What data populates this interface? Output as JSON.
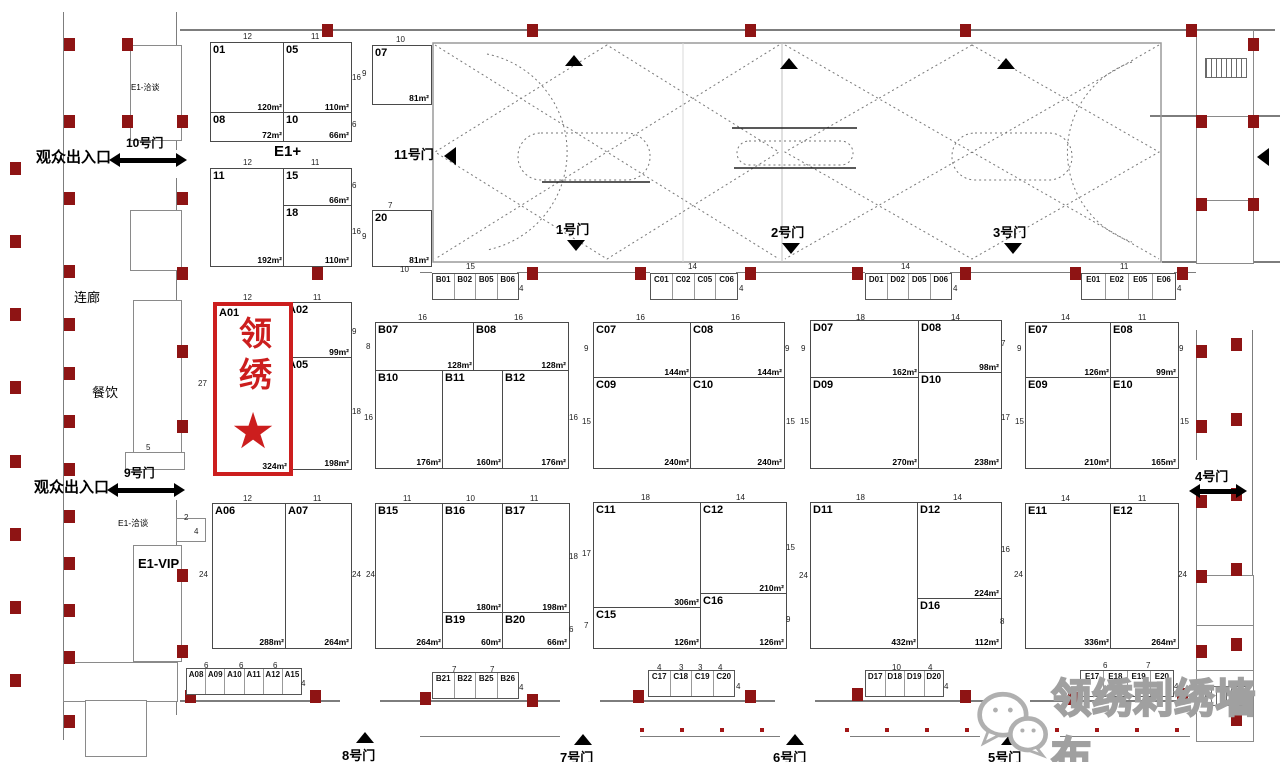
{
  "colors": {
    "highlight_red": "#cc1e1e",
    "column_red": "#8e1414",
    "wall_gray": "#7d7d7d",
    "watermark_gray": "#a0a0a0"
  },
  "labels": {
    "entrance_top": "观众出入口",
    "gate_10": "10号门",
    "entrance_mid": "观众出入口",
    "gate_9": "9号门",
    "gate_11": "11号门",
    "gate_1": "1号门",
    "gate_2": "2号门",
    "gate_3": "3号门",
    "gate_4": "4号门",
    "gate_5": "5号门",
    "gate_6": "6号门",
    "gate_7": "7号门",
    "gate_8": "8号门",
    "corridor": "连廊",
    "dining": "餐饮",
    "e1_talk_top": "E1-洽谈",
    "e1_talk": "E1-洽谈",
    "e1_vip": "E1-VIP",
    "e1_plus": "E1+"
  },
  "highlight": {
    "booth": "A01",
    "name": "领绣",
    "star": "★",
    "area": "324m²"
  },
  "watermark": {
    "text": "领绣刺绣墙布",
    "icon": "wechat-icon"
  },
  "booths": [
    {
      "id": "01",
      "area": "120m²",
      "x": 210,
      "y": 42,
      "w": 73,
      "h": 70
    },
    {
      "id": "05",
      "area": "110m²",
      "x": 283,
      "y": 42,
      "w": 67,
      "h": 70
    },
    {
      "id": "08",
      "area": "72m²",
      "x": 210,
      "y": 112,
      "w": 73,
      "h": 28
    },
    {
      "id": "10",
      "area": "66m²",
      "x": 283,
      "y": 112,
      "w": 67,
      "h": 28
    },
    {
      "id": "11",
      "area": "192m²",
      "x": 210,
      "y": 168,
      "w": 73,
      "h": 97
    },
    {
      "id": "15",
      "area": "66m²",
      "x": 283,
      "y": 168,
      "w": 67,
      "h": 37
    },
    {
      "id": "18",
      "area": "110m²",
      "x": 283,
      "y": 205,
      "w": 67,
      "h": 60
    },
    {
      "id": "07",
      "area": "81m²",
      "x": 372,
      "y": 45,
      "w": 58,
      "h": 58
    },
    {
      "id": "20",
      "area": "81m²",
      "x": 372,
      "y": 210,
      "w": 58,
      "h": 55
    },
    {
      "id": "A01",
      "area": "324m²",
      "x": 213,
      "y": 302,
      "w": 72,
      "h": 166,
      "highlight": true
    },
    {
      "id": "A02",
      "area": "99m²",
      "x": 285,
      "y": 302,
      "w": 65,
      "h": 55
    },
    {
      "id": "A05",
      "area": "198m²",
      "x": 285,
      "y": 357,
      "w": 65,
      "h": 111
    },
    {
      "id": "A06",
      "area": "288m²",
      "x": 212,
      "y": 503,
      "w": 73,
      "h": 144
    },
    {
      "id": "A07",
      "area": "264m²",
      "x": 285,
      "y": 503,
      "w": 65,
      "h": 144
    },
    {
      "id": "B07",
      "area": "128m²",
      "x": 375,
      "y": 322,
      "w": 98,
      "h": 48
    },
    {
      "id": "B08",
      "area": "128m²",
      "x": 473,
      "y": 322,
      "w": 94,
      "h": 48
    },
    {
      "id": "B10",
      "area": "176m²",
      "x": 375,
      "y": 370,
      "w": 67,
      "h": 97
    },
    {
      "id": "B11",
      "area": "160m²",
      "x": 442,
      "y": 370,
      "w": 60,
      "h": 97
    },
    {
      "id": "B12",
      "area": "176m²",
      "x": 502,
      "y": 370,
      "w": 65,
      "h": 97
    },
    {
      "id": "B15",
      "area": "264m²",
      "x": 375,
      "y": 503,
      "w": 67,
      "h": 144
    },
    {
      "id": "B16",
      "area": "180m²",
      "x": 442,
      "y": 503,
      "w": 60,
      "h": 109
    },
    {
      "id": "B17",
      "area": "198m²",
      "x": 502,
      "y": 503,
      "w": 66,
      "h": 109
    },
    {
      "id": "B19",
      "area": "60m²",
      "x": 442,
      "y": 612,
      "w": 60,
      "h": 35
    },
    {
      "id": "B20",
      "area": "66m²",
      "x": 502,
      "y": 612,
      "w": 66,
      "h": 35
    },
    {
      "id": "C07",
      "area": "144m²",
      "x": 593,
      "y": 322,
      "w": 97,
      "h": 55
    },
    {
      "id": "C08",
      "area": "144m²",
      "x": 690,
      "y": 322,
      "w": 93,
      "h": 55
    },
    {
      "id": "C09",
      "area": "240m²",
      "x": 593,
      "y": 377,
      "w": 97,
      "h": 90
    },
    {
      "id": "C10",
      "area": "240m²",
      "x": 690,
      "y": 377,
      "w": 93,
      "h": 90
    },
    {
      "id": "C11",
      "area": "306m²",
      "x": 593,
      "y": 502,
      "w": 107,
      "h": 105
    },
    {
      "id": "C12",
      "area": "210m²",
      "x": 700,
      "y": 502,
      "w": 85,
      "h": 91
    },
    {
      "id": "C15",
      "area": "126m²",
      "x": 593,
      "y": 607,
      "w": 107,
      "h": 40
    },
    {
      "id": "C16",
      "area": "126m²",
      "x": 700,
      "y": 593,
      "w": 85,
      "h": 54
    },
    {
      "id": "D07",
      "area": "162m²",
      "x": 810,
      "y": 320,
      "w": 108,
      "h": 57
    },
    {
      "id": "D08",
      "area": "98m²",
      "x": 918,
      "y": 320,
      "w": 82,
      "h": 52
    },
    {
      "id": "D09",
      "area": "270m²",
      "x": 810,
      "y": 377,
      "w": 108,
      "h": 90
    },
    {
      "id": "D10",
      "area": "238m²",
      "x": 918,
      "y": 372,
      "w": 82,
      "h": 95
    },
    {
      "id": "D11",
      "area": "432m²",
      "x": 810,
      "y": 502,
      "w": 107,
      "h": 145
    },
    {
      "id": "D12",
      "area": "224m²",
      "x": 917,
      "y": 502,
      "w": 83,
      "h": 96
    },
    {
      "id": "D16",
      "area": "112m²",
      "x": 917,
      "y": 598,
      "w": 83,
      "h": 49
    },
    {
      "id": "E07",
      "area": "126m²",
      "x": 1025,
      "y": 322,
      "w": 85,
      "h": 55
    },
    {
      "id": "E08",
      "area": "99m²",
      "x": 1110,
      "y": 322,
      "w": 67,
      "h": 55
    },
    {
      "id": "E09",
      "area": "210m²",
      "x": 1025,
      "y": 377,
      "w": 85,
      "h": 90
    },
    {
      "id": "E10",
      "area": "165m²",
      "x": 1110,
      "y": 377,
      "w": 67,
      "h": 90
    },
    {
      "id": "E11",
      "area": "336m²",
      "x": 1025,
      "y": 503,
      "w": 85,
      "h": 144
    },
    {
      "id": "E12",
      "area": "264m²",
      "x": 1110,
      "y": 503,
      "w": 67,
      "h": 144
    }
  ],
  "strips": [
    {
      "x": 432,
      "y": 273,
      "w": 85,
      "h": 25,
      "cells": [
        "B01",
        "B02",
        "B05",
        "B06"
      ]
    },
    {
      "x": 650,
      "y": 273,
      "w": 86,
      "h": 25,
      "cells": [
        "C01",
        "C02",
        "C05",
        "C06"
      ]
    },
    {
      "x": 865,
      "y": 273,
      "w": 85,
      "h": 25,
      "cells": [
        "D01",
        "D02",
        "D05",
        "D06"
      ]
    },
    {
      "x": 1081,
      "y": 273,
      "w": 93,
      "h": 25,
      "cells": [
        "E01",
        "E02",
        "E05",
        "E06"
      ]
    },
    {
      "x": 186,
      "y": 668,
      "w": 114,
      "h": 25,
      "cells": [
        "A08",
        "A09",
        "A10",
        "A11",
        "A12",
        "A15"
      ]
    },
    {
      "x": 432,
      "y": 672,
      "w": 85,
      "h": 25,
      "cells": [
        "B21",
        "B22",
        "B25",
        "B26"
      ]
    },
    {
      "x": 648,
      "y": 670,
      "w": 85,
      "h": 25,
      "cells": [
        "C17",
        "C18",
        "C19",
        "C20"
      ]
    },
    {
      "x": 865,
      "y": 670,
      "w": 77,
      "h": 25,
      "cells": [
        "D17",
        "D18",
        "D19",
        "D20"
      ]
    },
    {
      "x": 1080,
      "y": 670,
      "w": 92,
      "h": 25,
      "cells": [
        "E17",
        "E18",
        "E19",
        "E20"
      ]
    }
  ],
  "dims": [
    {
      "t": "12",
      "x": 243,
      "y": 33
    },
    {
      "t": "11",
      "x": 311,
      "y": 33
    },
    {
      "t": "16",
      "x": 352,
      "y": 74
    },
    {
      "t": "6",
      "x": 352,
      "y": 121
    },
    {
      "t": "10",
      "x": 396,
      "y": 36
    },
    {
      "t": "9",
      "x": 362,
      "y": 70
    },
    {
      "t": "12",
      "x": 243,
      "y": 159
    },
    {
      "t": "11",
      "x": 311,
      "y": 159
    },
    {
      "t": "6",
      "x": 352,
      "y": 182
    },
    {
      "t": "16",
      "x": 352,
      "y": 228
    },
    {
      "t": "7",
      "x": 388,
      "y": 202
    },
    {
      "t": "9",
      "x": 362,
      "y": 233
    },
    {
      "t": "10",
      "x": 400,
      "y": 266
    },
    {
      "t": "15",
      "x": 466,
      "y": 263
    },
    {
      "t": "4",
      "x": 519,
      "y": 285
    },
    {
      "t": "14",
      "x": 688,
      "y": 263
    },
    {
      "t": "4",
      "x": 739,
      "y": 285
    },
    {
      "t": "14",
      "x": 901,
      "y": 263
    },
    {
      "t": "4",
      "x": 953,
      "y": 285
    },
    {
      "t": "11",
      "x": 1120,
      "y": 263
    },
    {
      "t": "4",
      "x": 1177,
      "y": 285
    },
    {
      "t": "12",
      "x": 243,
      "y": 294
    },
    {
      "t": "11",
      "x": 313,
      "y": 294
    },
    {
      "t": "9",
      "x": 352,
      "y": 328
    },
    {
      "t": "18",
      "x": 352,
      "y": 408
    },
    {
      "t": "27",
      "x": 198,
      "y": 380
    },
    {
      "t": "16",
      "x": 418,
      "y": 314
    },
    {
      "t": "16",
      "x": 514,
      "y": 314
    },
    {
      "t": "8",
      "x": 366,
      "y": 343
    },
    {
      "t": "16",
      "x": 364,
      "y": 414
    },
    {
      "t": "16",
      "x": 569,
      "y": 414
    },
    {
      "t": "16",
      "x": 636,
      "y": 314
    },
    {
      "t": "16",
      "x": 731,
      "y": 314
    },
    {
      "t": "9",
      "x": 584,
      "y": 345
    },
    {
      "t": "9",
      "x": 785,
      "y": 345
    },
    {
      "t": "15",
      "x": 582,
      "y": 418
    },
    {
      "t": "15",
      "x": 786,
      "y": 418
    },
    {
      "t": "18",
      "x": 856,
      "y": 314
    },
    {
      "t": "14",
      "x": 951,
      "y": 314
    },
    {
      "t": "9",
      "x": 801,
      "y": 345
    },
    {
      "t": "7",
      "x": 1001,
      "y": 340
    },
    {
      "t": "15",
      "x": 800,
      "y": 418
    },
    {
      "t": "17",
      "x": 1001,
      "y": 414
    },
    {
      "t": "14",
      "x": 1061,
      "y": 314
    },
    {
      "t": "11",
      "x": 1138,
      "y": 314
    },
    {
      "t": "9",
      "x": 1017,
      "y": 345
    },
    {
      "t": "9",
      "x": 1179,
      "y": 345
    },
    {
      "t": "15",
      "x": 1015,
      "y": 418
    },
    {
      "t": "15",
      "x": 1180,
      "y": 418
    },
    {
      "t": "12",
      "x": 243,
      "y": 495
    },
    {
      "t": "11",
      "x": 313,
      "y": 495
    },
    {
      "t": "24",
      "x": 199,
      "y": 571
    },
    {
      "t": "24",
      "x": 352,
      "y": 571
    },
    {
      "t": "11",
      "x": 403,
      "y": 495
    },
    {
      "t": "10",
      "x": 466,
      "y": 495
    },
    {
      "t": "11",
      "x": 530,
      "y": 495
    },
    {
      "t": "24",
      "x": 366,
      "y": 571
    },
    {
      "t": "18",
      "x": 569,
      "y": 553
    },
    {
      "t": "6",
      "x": 569,
      "y": 626
    },
    {
      "t": "18",
      "x": 641,
      "y": 494
    },
    {
      "t": "14",
      "x": 736,
      "y": 494
    },
    {
      "t": "17",
      "x": 582,
      "y": 550
    },
    {
      "t": "15",
      "x": 786,
      "y": 544
    },
    {
      "t": "7",
      "x": 584,
      "y": 622
    },
    {
      "t": "9",
      "x": 786,
      "y": 616
    },
    {
      "t": "18",
      "x": 856,
      "y": 494
    },
    {
      "t": "14",
      "x": 953,
      "y": 494
    },
    {
      "t": "24",
      "x": 799,
      "y": 572
    },
    {
      "t": "16",
      "x": 1001,
      "y": 546
    },
    {
      "t": "8",
      "x": 1000,
      "y": 618
    },
    {
      "t": "14",
      "x": 1061,
      "y": 495
    },
    {
      "t": "11",
      "x": 1138,
      "y": 495
    },
    {
      "t": "24",
      "x": 1014,
      "y": 571
    },
    {
      "t": "24",
      "x": 1178,
      "y": 571
    },
    {
      "t": "6",
      "x": 204,
      "y": 662
    },
    {
      "t": "6",
      "x": 239,
      "y": 662
    },
    {
      "t": "6",
      "x": 273,
      "y": 662
    },
    {
      "t": "4",
      "x": 301,
      "y": 680
    },
    {
      "t": "7",
      "x": 452,
      "y": 666
    },
    {
      "t": "7",
      "x": 490,
      "y": 666
    },
    {
      "t": "4",
      "x": 519,
      "y": 684
    },
    {
      "t": "4",
      "x": 657,
      "y": 664
    },
    {
      "t": "3",
      "x": 679,
      "y": 664
    },
    {
      "t": "3",
      "x": 698,
      "y": 664
    },
    {
      "t": "4",
      "x": 718,
      "y": 664
    },
    {
      "t": "4",
      "x": 736,
      "y": 683
    },
    {
      "t": "10",
      "x": 892,
      "y": 664
    },
    {
      "t": "4",
      "x": 928,
      "y": 664
    },
    {
      "t": "4",
      "x": 944,
      "y": 683
    },
    {
      "t": "6",
      "x": 1103,
      "y": 662
    },
    {
      "t": "7",
      "x": 1146,
      "y": 662
    },
    {
      "t": "4",
      "x": 1174,
      "y": 683
    },
    {
      "t": "5",
      "x": 146,
      "y": 444
    },
    {
      "t": "2",
      "x": 184,
      "y": 514
    },
    {
      "t": "4",
      "x": 194,
      "y": 528
    }
  ]
}
